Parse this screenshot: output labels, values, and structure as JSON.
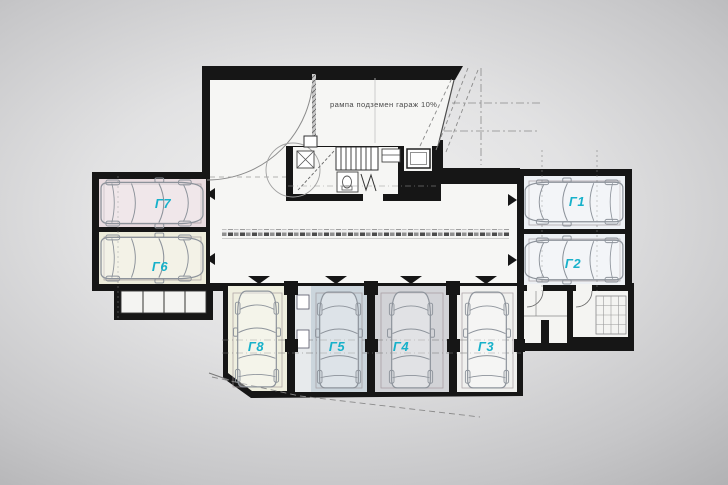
{
  "plan": {
    "ramp_label": "рампа подземен гараж 10%",
    "garages": [
      {
        "label": "Г1"
      },
      {
        "label": "Г2"
      },
      {
        "label": "Г3"
      },
      {
        "label": "Г4"
      },
      {
        "label": "Г5"
      },
      {
        "label": "Г6"
      },
      {
        "label": "Г7"
      },
      {
        "label": "Г8"
      }
    ],
    "colors": {
      "label": "#17b1ca",
      "wall": "#161616",
      "paper": "#f6f6f4",
      "g1_bg": "#edf0f4",
      "g2_bg": "#edf0f4",
      "g3_bg": "#f0f0ee",
      "g4_bg": "#d2d3d7",
      "g5_bg": "#cbd5dc",
      "g6_bg": "#edecdb",
      "g7_bg": "#e8dbdf",
      "g8_bg": "#efefdf",
      "locker_bg": "#f4f4f2"
    }
  }
}
